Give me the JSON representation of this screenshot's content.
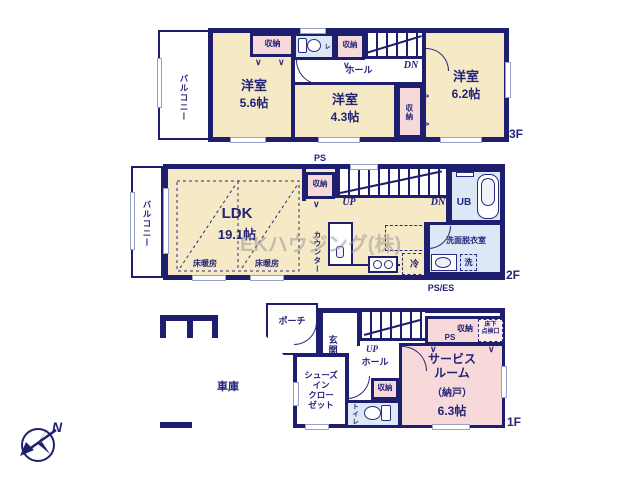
{
  "colors": {
    "wall": "#1e1e6e",
    "room_cream": "#f5e9c6",
    "closet_pink": "#f8d9d9",
    "wet_blue": "#dce8f5",
    "text_navy": "#232378",
    "watermark_gray": "#9a9a9a"
  },
  "watermark": "EKハウジング(株)",
  "compass": {
    "letter": "N"
  },
  "f3": {
    "floor_label": "3F",
    "balcony": "バルコニー",
    "closet_a": "収納",
    "toilet": "トイレ",
    "closet_b": "収納",
    "dn": "DN",
    "hall": "ホール",
    "room1_name": "洋室",
    "room1_size": "5.6帖",
    "room2_name": "洋室",
    "room2_size": "4.3帖",
    "closet_c": "収納",
    "room3_name": "洋室",
    "room3_size": "6.2帖"
  },
  "f2": {
    "floor_label": "2F",
    "ps": "PS",
    "balcony": "バルコニー",
    "closet": "収納",
    "up": "UP",
    "dn": "DN",
    "ub": "UB",
    "washroom": "洗面脱衣室",
    "ldk_name": "LDK",
    "ldk_size": "19.1帖",
    "heating1": "床暖房",
    "heating2": "床暖房",
    "counter": "カウンター",
    "fridge": "冷",
    "washer": "洗",
    "ps_es": "PS/ES"
  },
  "f1": {
    "floor_label": "1F",
    "garage": "車庫",
    "porch": "ポーチ",
    "entrance": "玄関",
    "up": "UP",
    "hall": "ホール",
    "shoes_closet": "シューズ\nイン\nクロー\nゼット",
    "closet": "収納",
    "toilet": "トイレ",
    "ps_side": "PS",
    "closet_top": "収納",
    "ps_top": "PS",
    "hatch": "床下\n点検口",
    "service_name": "サービス\nルーム",
    "service_alt": "（納戸）",
    "service_size": "6.3帖"
  }
}
